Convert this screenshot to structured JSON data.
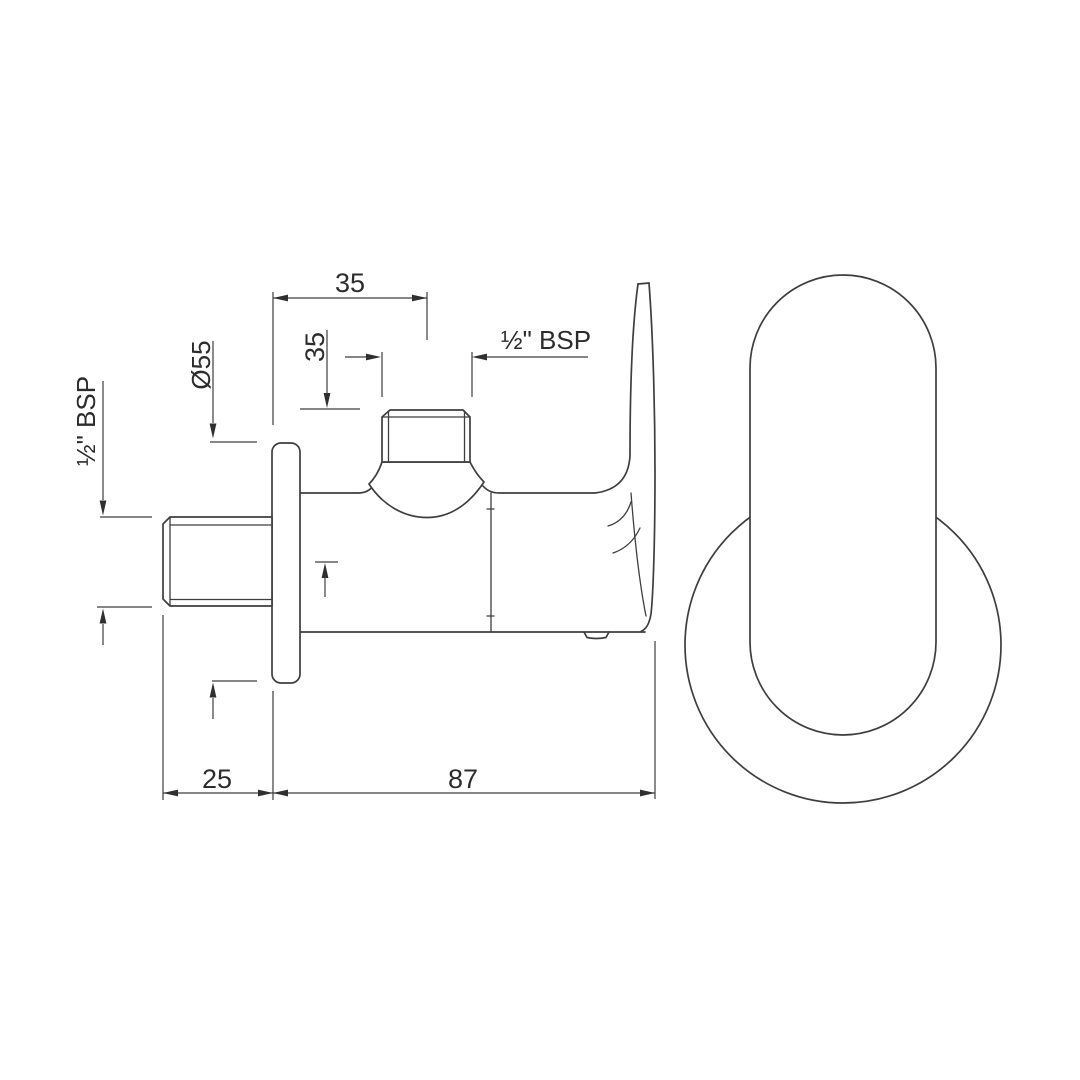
{
  "drawing": {
    "dimensions": {
      "top_offset": "35",
      "outlet_height": "35",
      "outlet_thread": "½\" BSP",
      "inlet_thread": "½\" BSP",
      "flange_diameter": "Ø55",
      "wall_clearance": "25",
      "overall_length": "87"
    },
    "colors": {
      "line": "#3e3e3e",
      "text": "#2c2c2c",
      "background": "#ffffff"
    }
  }
}
